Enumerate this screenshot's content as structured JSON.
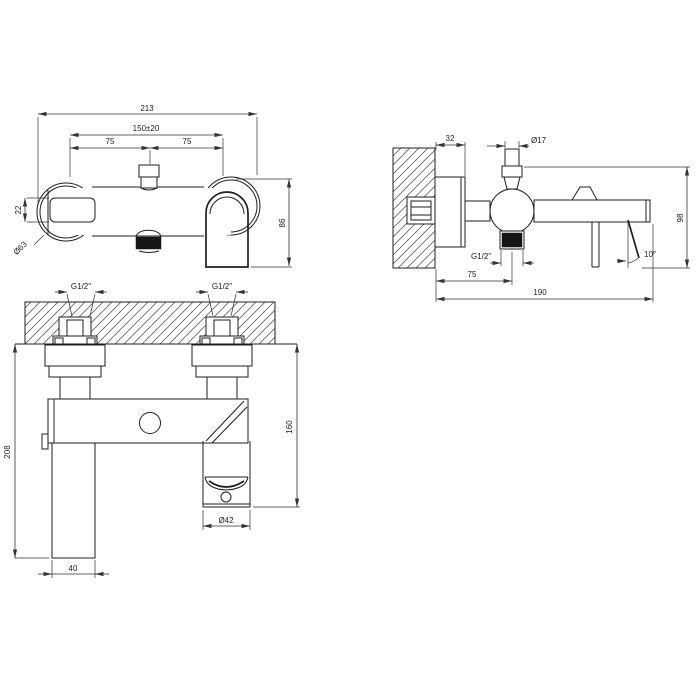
{
  "drawing": {
    "kind": "faucet-technical-drawing",
    "colors": {
      "line": "#1f1f1f",
      "background": "#ffffff",
      "dark_fill": "#161616"
    }
  },
  "views": {
    "front": {
      "dims": {
        "total_width": "213",
        "inlet_spacing": "150±20",
        "left_offset": "75",
        "right_offset": "75",
        "window_height": "22",
        "escutcheon_diameter": "Ø63",
        "height": "86"
      }
    },
    "side": {
      "dims": {
        "escutcheon_depth": "32",
        "top_port_diameter": "Ø17",
        "height": "98",
        "outlet_thread": "G1/2\"",
        "outlet_offset": "75",
        "projection": "190",
        "handle_angle": "10°"
      }
    },
    "installed": {
      "dims": {
        "inlet_thread_left": "G1/2\"",
        "inlet_thread_right": "G1/2\"",
        "overall_height": "208",
        "spout_height": "160",
        "handle_width": "40",
        "spout_diameter": "Ø42"
      }
    }
  }
}
